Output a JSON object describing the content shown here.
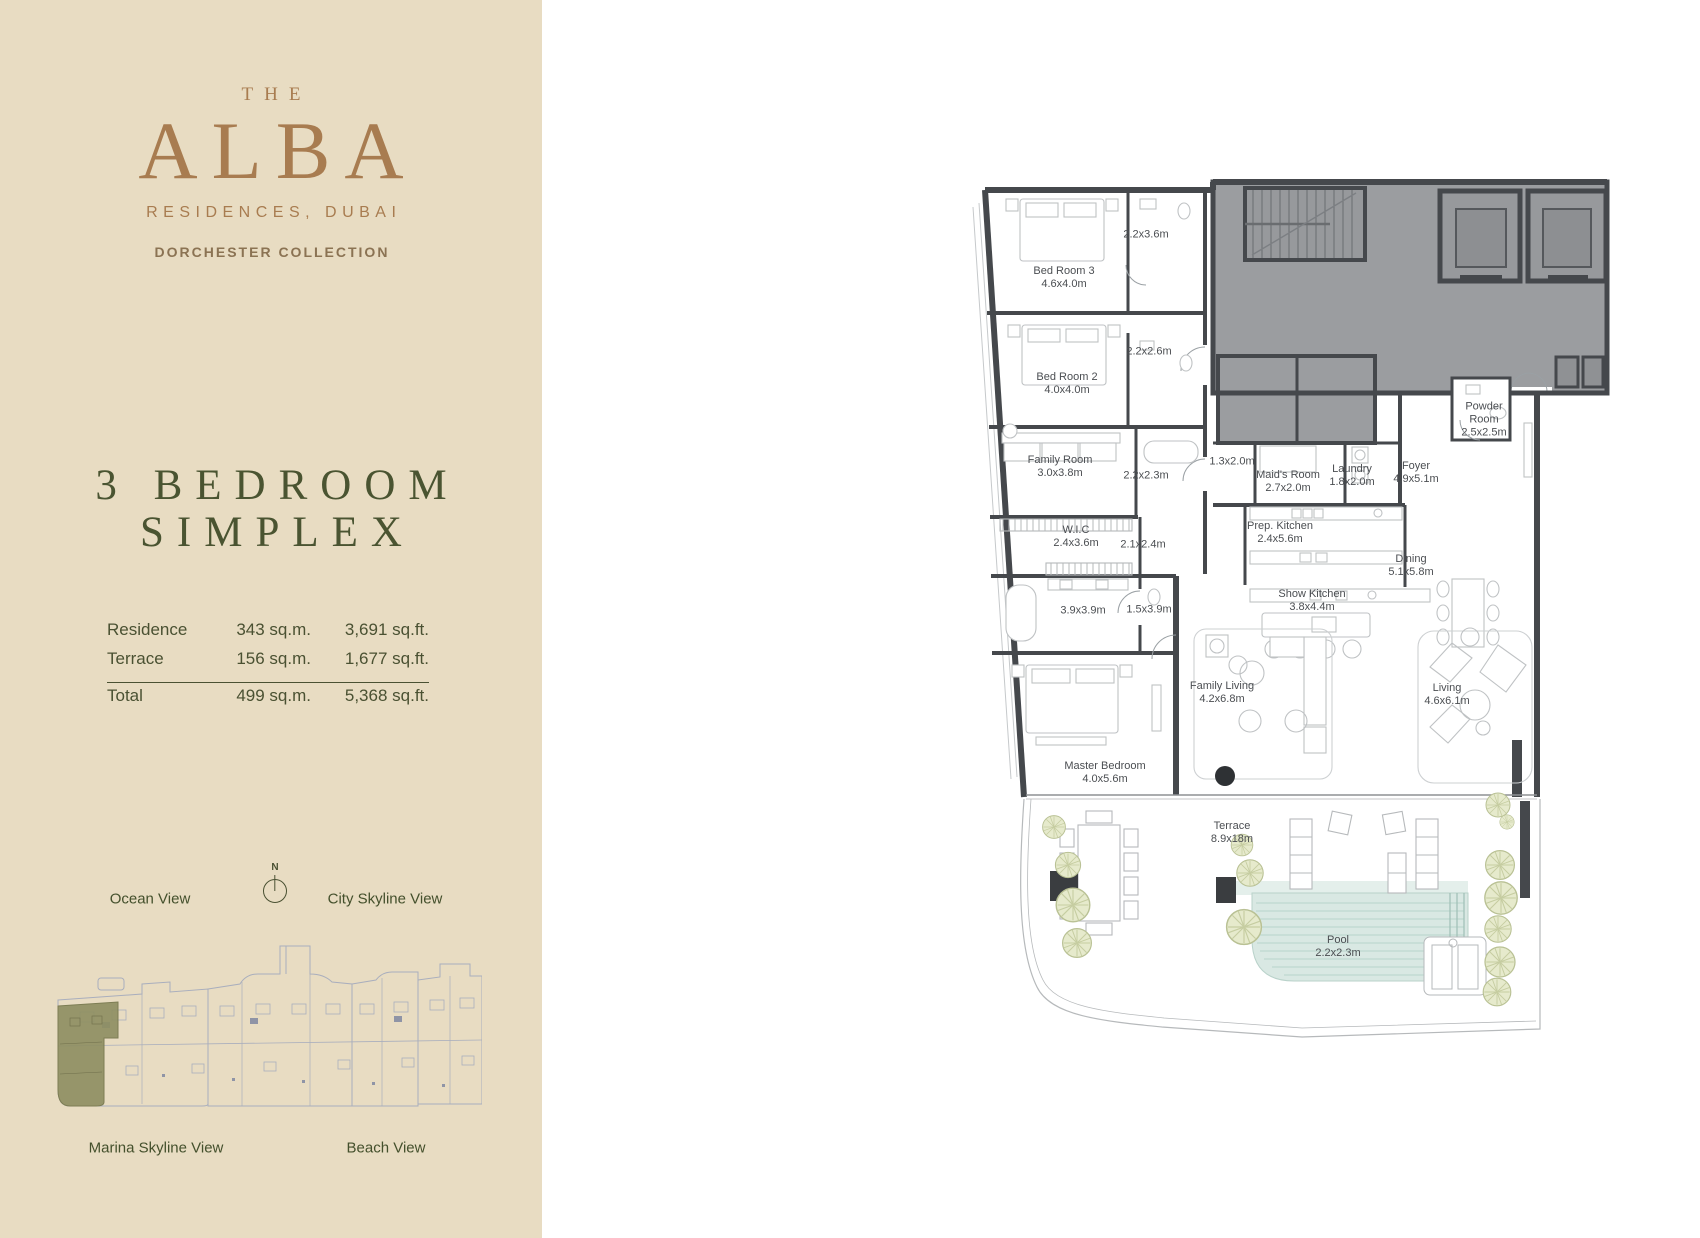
{
  "brand": {
    "the": "THE",
    "name": "ALBA",
    "subtitle": "RESIDENCES, DUBAI",
    "collection": "DORCHESTER COLLECTION"
  },
  "unit": {
    "title_line1": "3 BEDROOM",
    "title_line2": "SIMPLEX"
  },
  "area_table": {
    "rows": [
      {
        "label": "Residence",
        "sqm": "343 sq.m.",
        "sqft": "3,691 sq.ft."
      },
      {
        "label": "Terrace",
        "sqm": "156 sq.m.",
        "sqft": "1,677 sq.ft."
      },
      {
        "label": "Total",
        "sqm": "499 sq.m.",
        "sqft": "5,368 sq.ft."
      }
    ]
  },
  "views": {
    "ocean": "Ocean View",
    "city": "City Skyline View",
    "marina": "Marina Skyline View",
    "beach": "Beach View",
    "compass_n": "N"
  },
  "floor_plan": {
    "rooms": {
      "bedroom3": {
        "name": "Bed Room 3",
        "dims": "4.6x4.0m"
      },
      "bath_a": {
        "name": "",
        "dims": "2.2x3.6m"
      },
      "bedroom2": {
        "name": "Bed Room 2",
        "dims": "4.0x4.0m"
      },
      "bath_b": {
        "name": "",
        "dims": "2.2x2.6m"
      },
      "family_room": {
        "name": "Family Room",
        "dims": "3.0x3.8m"
      },
      "bath_c": {
        "name": "",
        "dims": "2.2x2.3m"
      },
      "wic": {
        "name": "W.I.C",
        "dims": "2.4x3.6m"
      },
      "hall": {
        "name": "",
        "dims": "2.1x2.4m"
      },
      "master_bath": {
        "name": "",
        "dims": "3.9x3.9m"
      },
      "shower": {
        "name": "",
        "dims": "1.5x3.9m"
      },
      "store": {
        "name": "",
        "dims": "1.3x2.0m"
      },
      "maids_room": {
        "name": "Maid's Room",
        "dims": "2.7x2.0m"
      },
      "laundry": {
        "name": "Laundry",
        "dims": "1.8x2.0m"
      },
      "foyer": {
        "name": "Foyer",
        "dims": "4.9x5.1m"
      },
      "powder_room": {
        "name": "Powder Room",
        "dims": "2.5x2.5m"
      },
      "prep_kitchen": {
        "name": "Prep. Kitchen",
        "dims": "2.4x5.6m"
      },
      "dining": {
        "name": "Dining",
        "dims": "5.1x5.8m"
      },
      "show_kitchen": {
        "name": "Show Kitchen",
        "dims": "3.8x4.4m"
      },
      "family_living": {
        "name": "Family Living",
        "dims": "4.2x6.8m"
      },
      "living": {
        "name": "Living",
        "dims": "4.6x6.1m"
      },
      "master_bedroom": {
        "name": "Master Bedroom",
        "dims": "4.0x5.6m"
      },
      "terrace": {
        "name": "Terrace",
        "dims": "8.9x18m"
      },
      "pool": {
        "name": "Pool",
        "dims": "2.2x2.3m"
      }
    }
  },
  "colors": {
    "sidebar_bg": "#e8dcc2",
    "brand_bronze": "#a87c50",
    "collection_brown": "#8b7353",
    "olive_text": "#4a5132",
    "plan_wall": "#45484c",
    "core_fill": "#9b9da0",
    "pool_fill": "#d9e8e3",
    "tree_fill": "#e6eacc",
    "highlight_olive": "#8e8e63",
    "miniplan_line": "#a9aebd"
  }
}
